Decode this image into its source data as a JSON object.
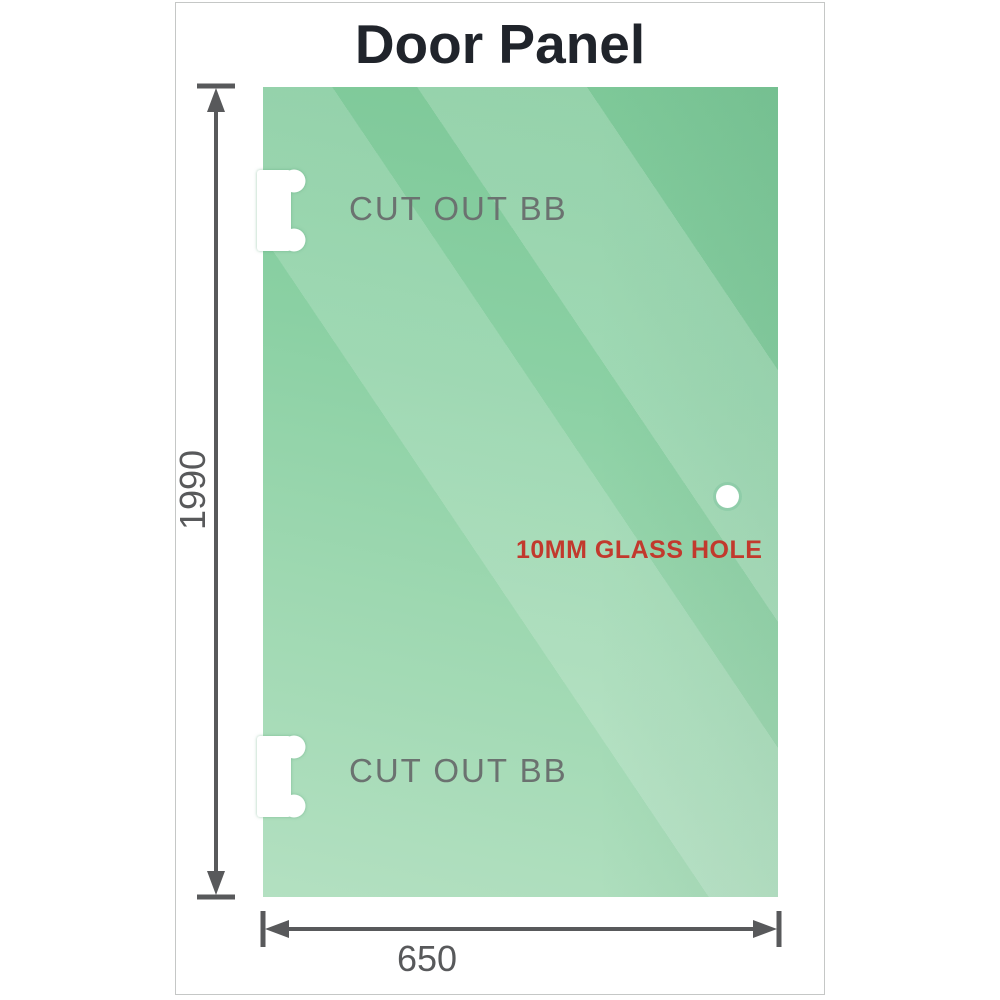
{
  "title": "Door Panel",
  "panel": {
    "cutouts": [
      {
        "label": "CUT OUT BB"
      },
      {
        "label": "CUT OUT BB"
      }
    ],
    "hole": {
      "label": "10MM GLASS HOLE"
    }
  },
  "dimensions": {
    "height": {
      "value": "1990"
    },
    "width": {
      "value": "650"
    }
  },
  "colors": {
    "glass-dark": "#7cc797",
    "glass-light": "#b3e0c1",
    "frame-border": "#c5c7c6",
    "dimension": "#58595b",
    "label-gray": "#6b7270",
    "annotation-red": "#c2392d",
    "title-color": "#20242b",
    "cutout-white": "#ffffff"
  }
}
